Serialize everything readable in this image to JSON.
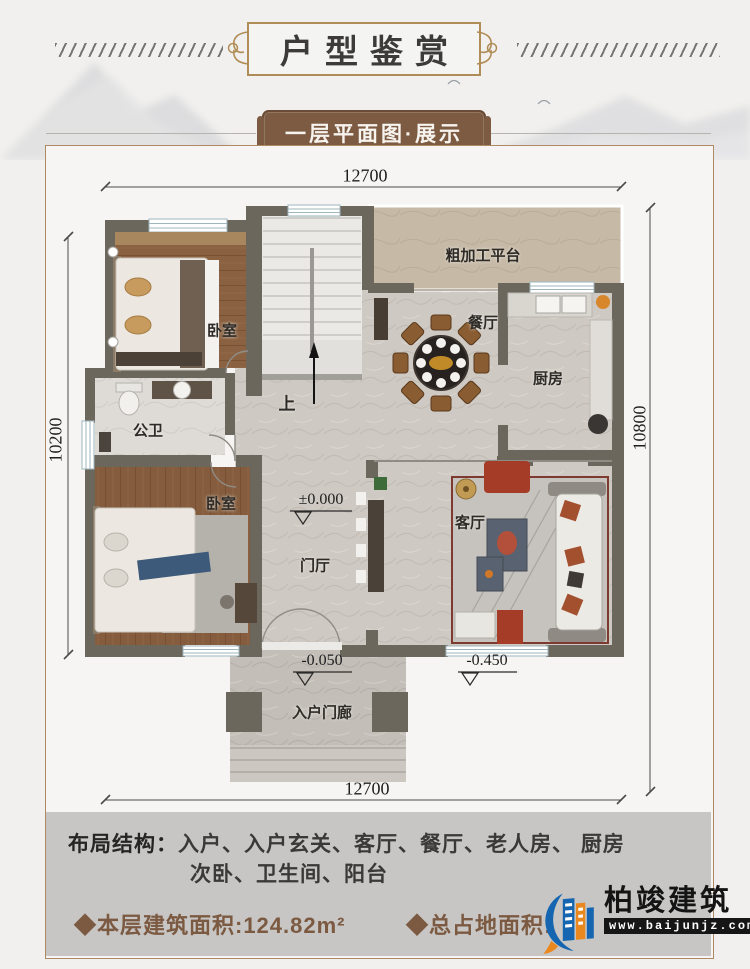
{
  "header": {
    "title": "户型鉴赏"
  },
  "banner": {
    "subtitle": "一层平面图·展示"
  },
  "plan": {
    "dims": {
      "top": "12700",
      "bottom": "12700",
      "left": "10200",
      "right": "10800"
    },
    "rooms": {
      "platform": "粗加工平台",
      "bedroom_top": "卧室",
      "dining": "餐厅",
      "kitchen": "厨房",
      "bathroom": "公卫",
      "bedroom_bottom": "卧室",
      "foyer": "门厅",
      "living": "客厅",
      "porch": "入户门廊",
      "stair_up": "上"
    },
    "elevations": {
      "zero": "±0.000",
      "porch": "-0.050",
      "yard": "-0.450"
    }
  },
  "footer": {
    "layout_label": "布局结构：",
    "layout_line1": "入户、入户玄关、客厅、餐厅、老人房、 厨房",
    "layout_line2": "次卧、卫生间、阳台",
    "floor_area": "◆本层建筑面积:124.82m²",
    "total_area": "◆总占地面积:",
    "brand": "柏竣建筑",
    "brand_url": "www.baijunjz.com"
  },
  "colors": {
    "accent_brown": "#7c5a42",
    "banner_brown": "#7d5b43",
    "wall": "#6b675c",
    "logo_blue": "#1565b0",
    "logo_orange": "#e8881f"
  }
}
